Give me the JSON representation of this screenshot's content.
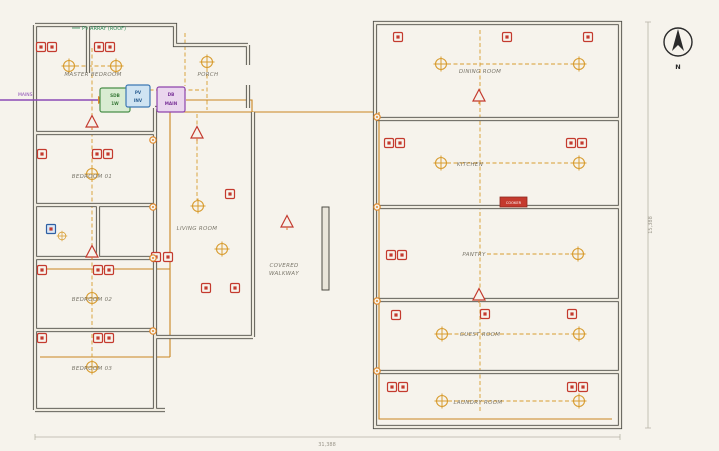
{
  "drawing": {
    "rooms": {
      "master_bedroom": "MASTER BEDROOM",
      "porch": "PORCH",
      "bedroom_01": "BEDROOM 01",
      "bedroom_02": "BEDROOM 02",
      "bedroom_03": "BEDROOM 03",
      "living_room": "LIVING ROOM",
      "covered_walkway_line1": "COVERED",
      "covered_walkway_line2": "WALKWAY",
      "dining_room": "DINING ROOM",
      "kitchen": "KITCHEN",
      "pantry": "PANTRY",
      "guest_room": "GUEST ROOM",
      "laundry_room": "LAUNDRY ROOM"
    },
    "annotations": {
      "pv_array": "PV ARRAY (ROOF)",
      "mains_supply": "MAINS",
      "cooker": "COOKER"
    },
    "panels": {
      "sdb_line1": "SDB",
      "sdb_line2": "1W",
      "inverter_line1": "PV",
      "inverter_line2": "INV",
      "main_db_line1": "DB",
      "main_db_line2": "MAIN"
    },
    "dimensions": {
      "overall_width": "31,388",
      "overall_height": "15,388"
    },
    "compass": {
      "north_label": "N"
    },
    "symbols_legend": {
      "socket_outlet": "socket-outlet-icon",
      "ceiling_light": "ceiling-light-icon",
      "switch_triangle": "switch-icon",
      "junction_node": "junction-node-icon",
      "exhaust_fan": "exhaust-fan-icon"
    },
    "colors": {
      "background": "#F6F3EC",
      "wall": "#4D4C45",
      "socket_red": "#C43A2E",
      "wiring_orange": "#D89C2F",
      "conduit_orange": "#C9851F",
      "mains_purple": "#8B4BB5",
      "panel_green": "#4A8F4A",
      "panel_blue": "#3C78B4",
      "panel_purple": "#8E44AD",
      "pv_text_green": "#2E8B57"
    }
  }
}
